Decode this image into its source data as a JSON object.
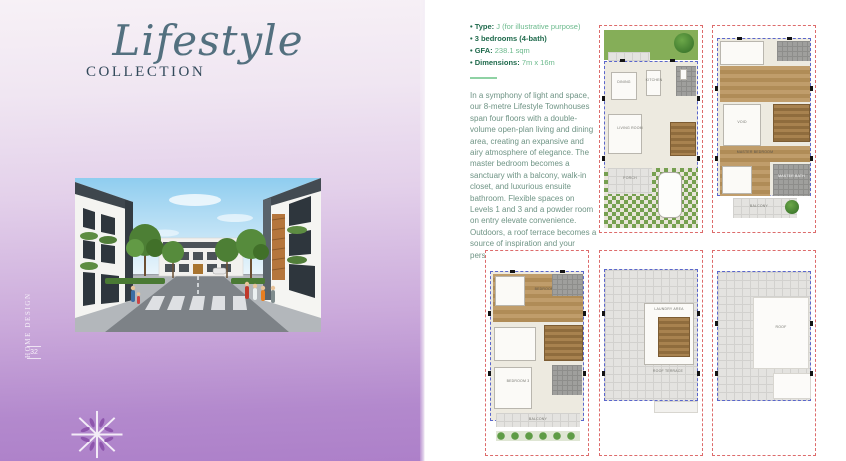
{
  "left_panel": {
    "title_script": "Lifestyle",
    "title_caps": "COLLECTION",
    "vertical_text": "HOME DESIGN",
    "page_number": "32"
  },
  "specs": {
    "bullets": [
      {
        "label": "Type:",
        "value": "J (for illustrative purpose)"
      },
      {
        "label": "3 bedrooms (4-bath)",
        "value": ""
      },
      {
        "label": "GFA:",
        "value": "238.1 sqm"
      },
      {
        "label": "Dimensions:",
        "value": "7m x 16m"
      }
    ],
    "description": "In a symphony of light and space, our 8-metre Lifestyle Townhouses span four floors with a double-volume open-plan living and dining area, creating an expansive and airy atmosphere of elegance. The master bedroom becomes a sanctuary with a balcony, walk-in closet, and luxurious ensuite bathroom. Flexible spaces on Levels 1 and 3 and a powder room on entry elevate convenience. Outdoors, a roof terrace becomes a source of inspiration and your personal interface with nature."
  },
  "floorplans": [
    {
      "id": "level-1",
      "rooms": {
        "dining": "DINING",
        "kitchen": "KITCHEN",
        "living": "LIVING ROOM",
        "porch": "PORCH"
      }
    },
    {
      "id": "level-2",
      "rooms": {
        "void": "VOID",
        "master_bedroom": "MASTER BEDROOM",
        "master_bath": "MASTER BATH",
        "balcony": "BALCONY"
      }
    },
    {
      "id": "level-3",
      "rooms": {
        "bedroom2": "BEDROOM 2",
        "bedroom3": "BEDROOM 3",
        "balcony": "BALCONY"
      }
    },
    {
      "id": "roof-terrace",
      "rooms": {
        "laundry": "LAUNDRY AREA",
        "terrace": "ROOF TERRACE"
      }
    },
    {
      "id": "roof",
      "rooms": {
        "roof": "ROOF"
      }
    }
  ],
  "colors": {
    "panel_purple": "#ad80c9",
    "spec_bold_green": "#1f6a4c",
    "spec_value_green": "#6cba8d",
    "body_text_green": "#6f9485",
    "plan_boundary_red": "#dd6b6b",
    "plan_setback_blue": "#5a66cc"
  }
}
